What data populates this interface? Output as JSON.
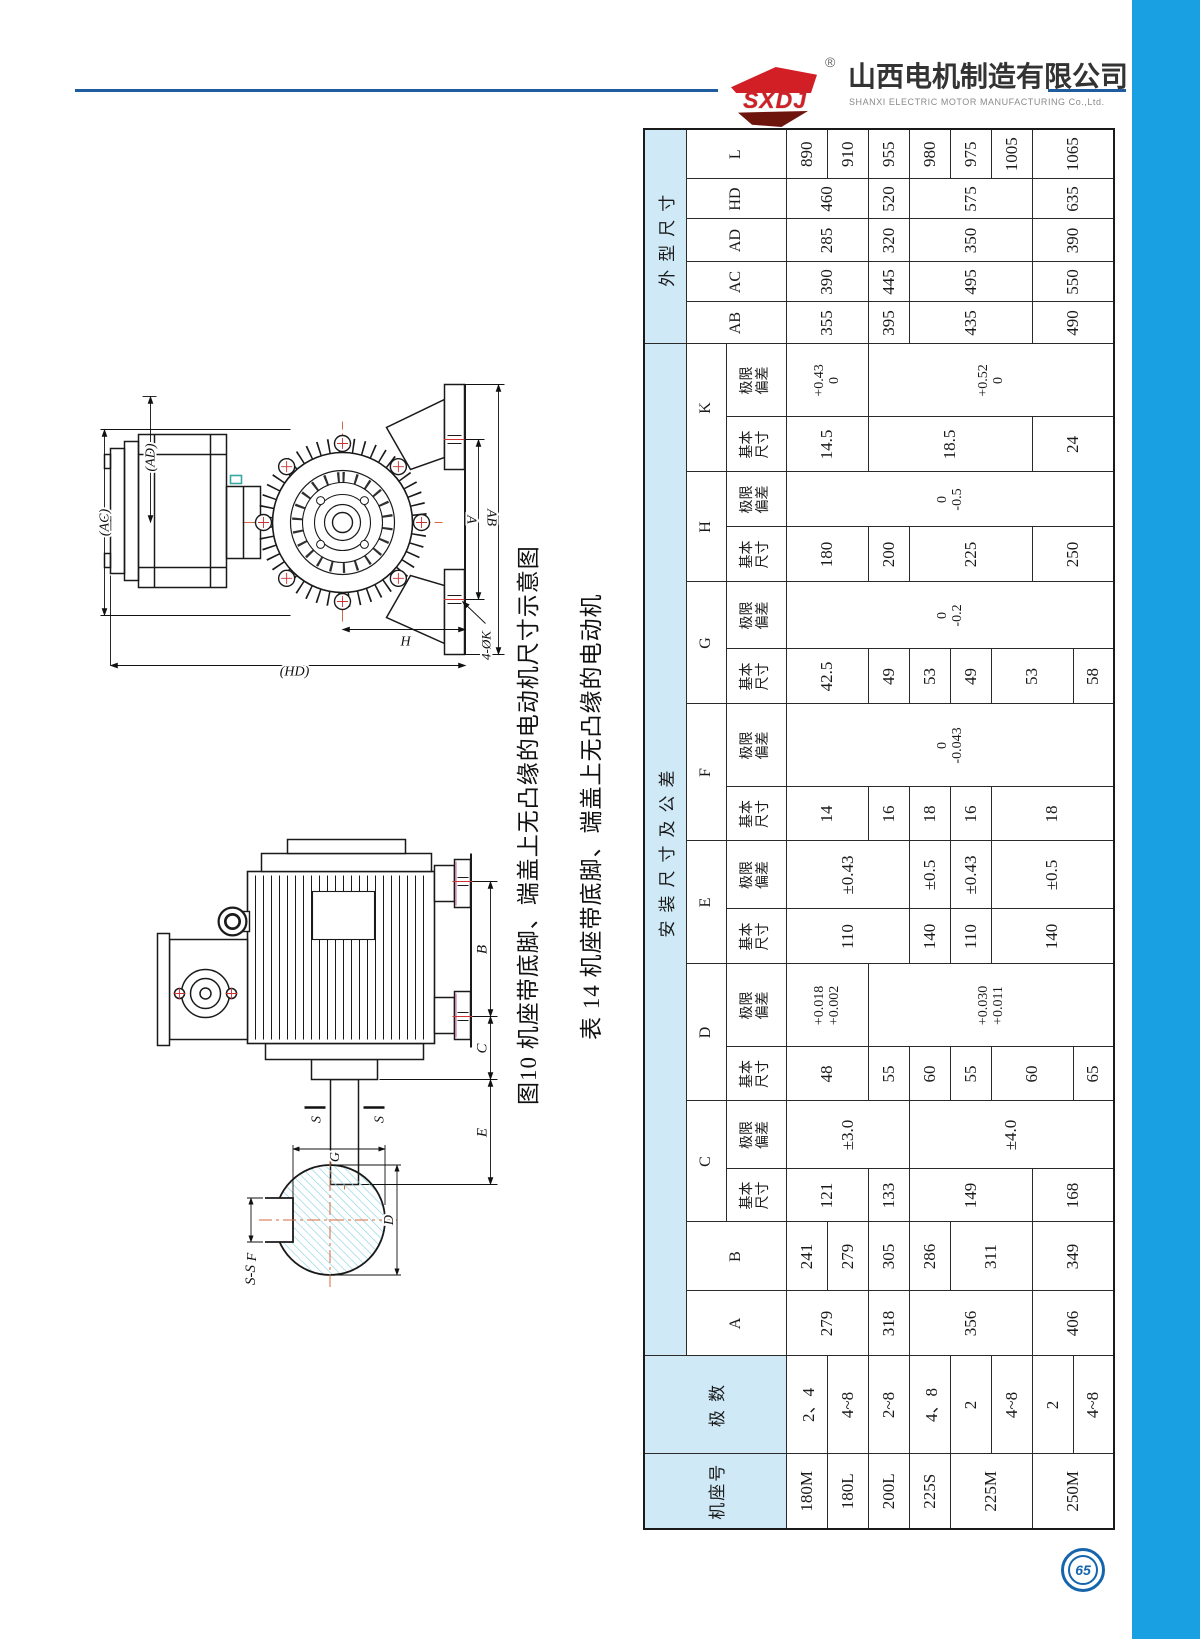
{
  "header": {
    "logo_text": "SXDJ",
    "registered_mark": "®",
    "company_cn": "山西电机制造有限公司",
    "company_en": "SHANXI ELECTRIC MOTOR MANUFACTURING Co.,Ltd.",
    "rule_color": "#1e5c9e"
  },
  "accent_bar_color": "#19a0e3",
  "page_number": "65",
  "captions": {
    "figure": "图10 机座带底脚、端盖上无凸缘的电动机尺寸示意图",
    "table": "表 14 机座带底脚、端盖上无凸缘的电动机"
  },
  "figure_labels": {
    "ac": "(AC)",
    "ad": "(AD)",
    "a": "A",
    "ab": "AB",
    "h": "H",
    "hd": "(HD)",
    "k4": "4-ØK",
    "b": "B",
    "c": "C",
    "e": "E",
    "s1": "S",
    "s2": "S",
    "ss": "S-S",
    "g": "G",
    "f": "F",
    "d": "D"
  },
  "table": {
    "corner": {
      "frame": "机座号",
      "poles": "极 数"
    },
    "groups": {
      "install": "安装尺寸及公差",
      "overall": "外型尺寸"
    },
    "sub": {
      "basic": "基本\n尺寸",
      "tol": "极限\n偏差"
    },
    "dim_letters": {
      "single": [
        "A",
        "B"
      ],
      "double": [
        "C",
        "D",
        "E",
        "F",
        "G",
        "H",
        "K"
      ],
      "overall": [
        "AB",
        "AC",
        "AD",
        "HD",
        "L"
      ]
    },
    "col_order": [
      "frame",
      "poles",
      "A",
      "B",
      "C_basic",
      "C_tol",
      "D_basic",
      "D_tol",
      "E_basic",
      "E_tol",
      "F_basic",
      "F_tol",
      "G_basic",
      "G_tol",
      "H_basic",
      "H_tol",
      "K_basic",
      "K_tol",
      "AB",
      "AC",
      "AD",
      "HD",
      "L"
    ],
    "col_widths": [
      75,
      98,
      65,
      69,
      53,
      68,
      54,
      83,
      55,
      68,
      54,
      83,
      55,
      67,
      55,
      55,
      55,
      73,
      42,
      40,
      43,
      40,
      50
    ],
    "columns": {
      "frame": [
        [
          "180M",
          1
        ],
        [
          "180L",
          1
        ],
        [
          "200L",
          1
        ],
        [
          "225S",
          1
        ],
        [
          "225M",
          2
        ],
        [
          "250M",
          2
        ]
      ],
      "poles": [
        [
          "2、4",
          1
        ],
        [
          "4~8",
          1
        ],
        [
          "2~8",
          1
        ],
        [
          "4、8",
          1
        ],
        [
          "2",
          1
        ],
        [
          "4~8",
          1
        ],
        [
          "2",
          1
        ],
        [
          "4~8",
          1
        ]
      ],
      "A": [
        [
          "279",
          2
        ],
        [
          "318",
          1
        ],
        [
          "356",
          3
        ],
        [
          "406",
          2
        ]
      ],
      "B": [
        [
          "241",
          1
        ],
        [
          "279",
          1
        ],
        [
          "305",
          1
        ],
        [
          "286",
          1
        ],
        [
          "311",
          2
        ],
        [
          "349",
          2
        ]
      ],
      "C_basic": [
        [
          "121",
          2
        ],
        [
          "133",
          1
        ],
        [
          "149",
          3
        ],
        [
          "168",
          2
        ]
      ],
      "C_tol": [
        [
          "±3.0",
          3
        ],
        [
          "±4.0",
          5
        ]
      ],
      "D_basic": [
        [
          "48",
          2
        ],
        [
          "55",
          1
        ],
        [
          "60",
          1
        ],
        [
          "55",
          1
        ],
        [
          "60",
          2
        ],
        [
          "65",
          1
        ]
      ],
      "D_tol": [
        [
          "+0.018\n+0.002",
          2
        ],
        [
          "+0.030\n+0.011",
          6
        ]
      ],
      "E_basic": [
        [
          "110",
          3
        ],
        [
          "140",
          1
        ],
        [
          "110",
          1
        ],
        [
          "140",
          3
        ]
      ],
      "E_tol": [
        [
          "±0.43",
          3
        ],
        [
          "±0.5",
          1
        ],
        [
          "±0.43",
          1
        ],
        [
          "±0.5",
          3
        ]
      ],
      "F_basic": [
        [
          "14",
          2
        ],
        [
          "16",
          1
        ],
        [
          "18",
          1
        ],
        [
          "16",
          1
        ],
        [
          "18",
          3
        ]
      ],
      "F_tol": [
        [
          "0\n-0.043",
          8
        ]
      ],
      "G_basic": [
        [
          "42.5",
          2
        ],
        [
          "49",
          1
        ],
        [
          "53",
          1
        ],
        [
          "49",
          1
        ],
        [
          "53",
          2
        ],
        [
          "58",
          1
        ]
      ],
      "G_tol": [
        [
          "0\n-0.2",
          8
        ]
      ],
      "H_basic": [
        [
          "180",
          2
        ],
        [
          "200",
          1
        ],
        [
          "225",
          3
        ],
        [
          "250",
          2
        ]
      ],
      "H_tol": [
        [
          "0\n-0.5",
          8
        ]
      ],
      "K_basic": [
        [
          "14.5",
          2
        ],
        [
          "18.5",
          4
        ],
        [
          "24",
          2
        ]
      ],
      "K_tol": [
        [
          "+0.43\n0",
          2
        ],
        [
          "+0.52\n0",
          6
        ]
      ],
      "AB": [
        [
          "355",
          2
        ],
        [
          "395",
          1
        ],
        [
          "435",
          3
        ],
        [
          "490",
          2
        ]
      ],
      "AC": [
        [
          "390",
          2
        ],
        [
          "445",
          1
        ],
        [
          "495",
          3
        ],
        [
          "550",
          2
        ]
      ],
      "AD": [
        [
          "285",
          2
        ],
        [
          "320",
          1
        ],
        [
          "350",
          3
        ],
        [
          "390",
          2
        ]
      ],
      "HD": [
        [
          "460",
          2
        ],
        [
          "520",
          1
        ],
        [
          "575",
          3
        ],
        [
          "635",
          2
        ]
      ],
      "L": [
        [
          "890",
          1
        ],
        [
          "910",
          1
        ],
        [
          "955",
          1
        ],
        [
          "980",
          1
        ],
        [
          "975",
          1
        ],
        [
          "1005",
          1
        ],
        [
          "1065",
          2
        ]
      ]
    }
  }
}
